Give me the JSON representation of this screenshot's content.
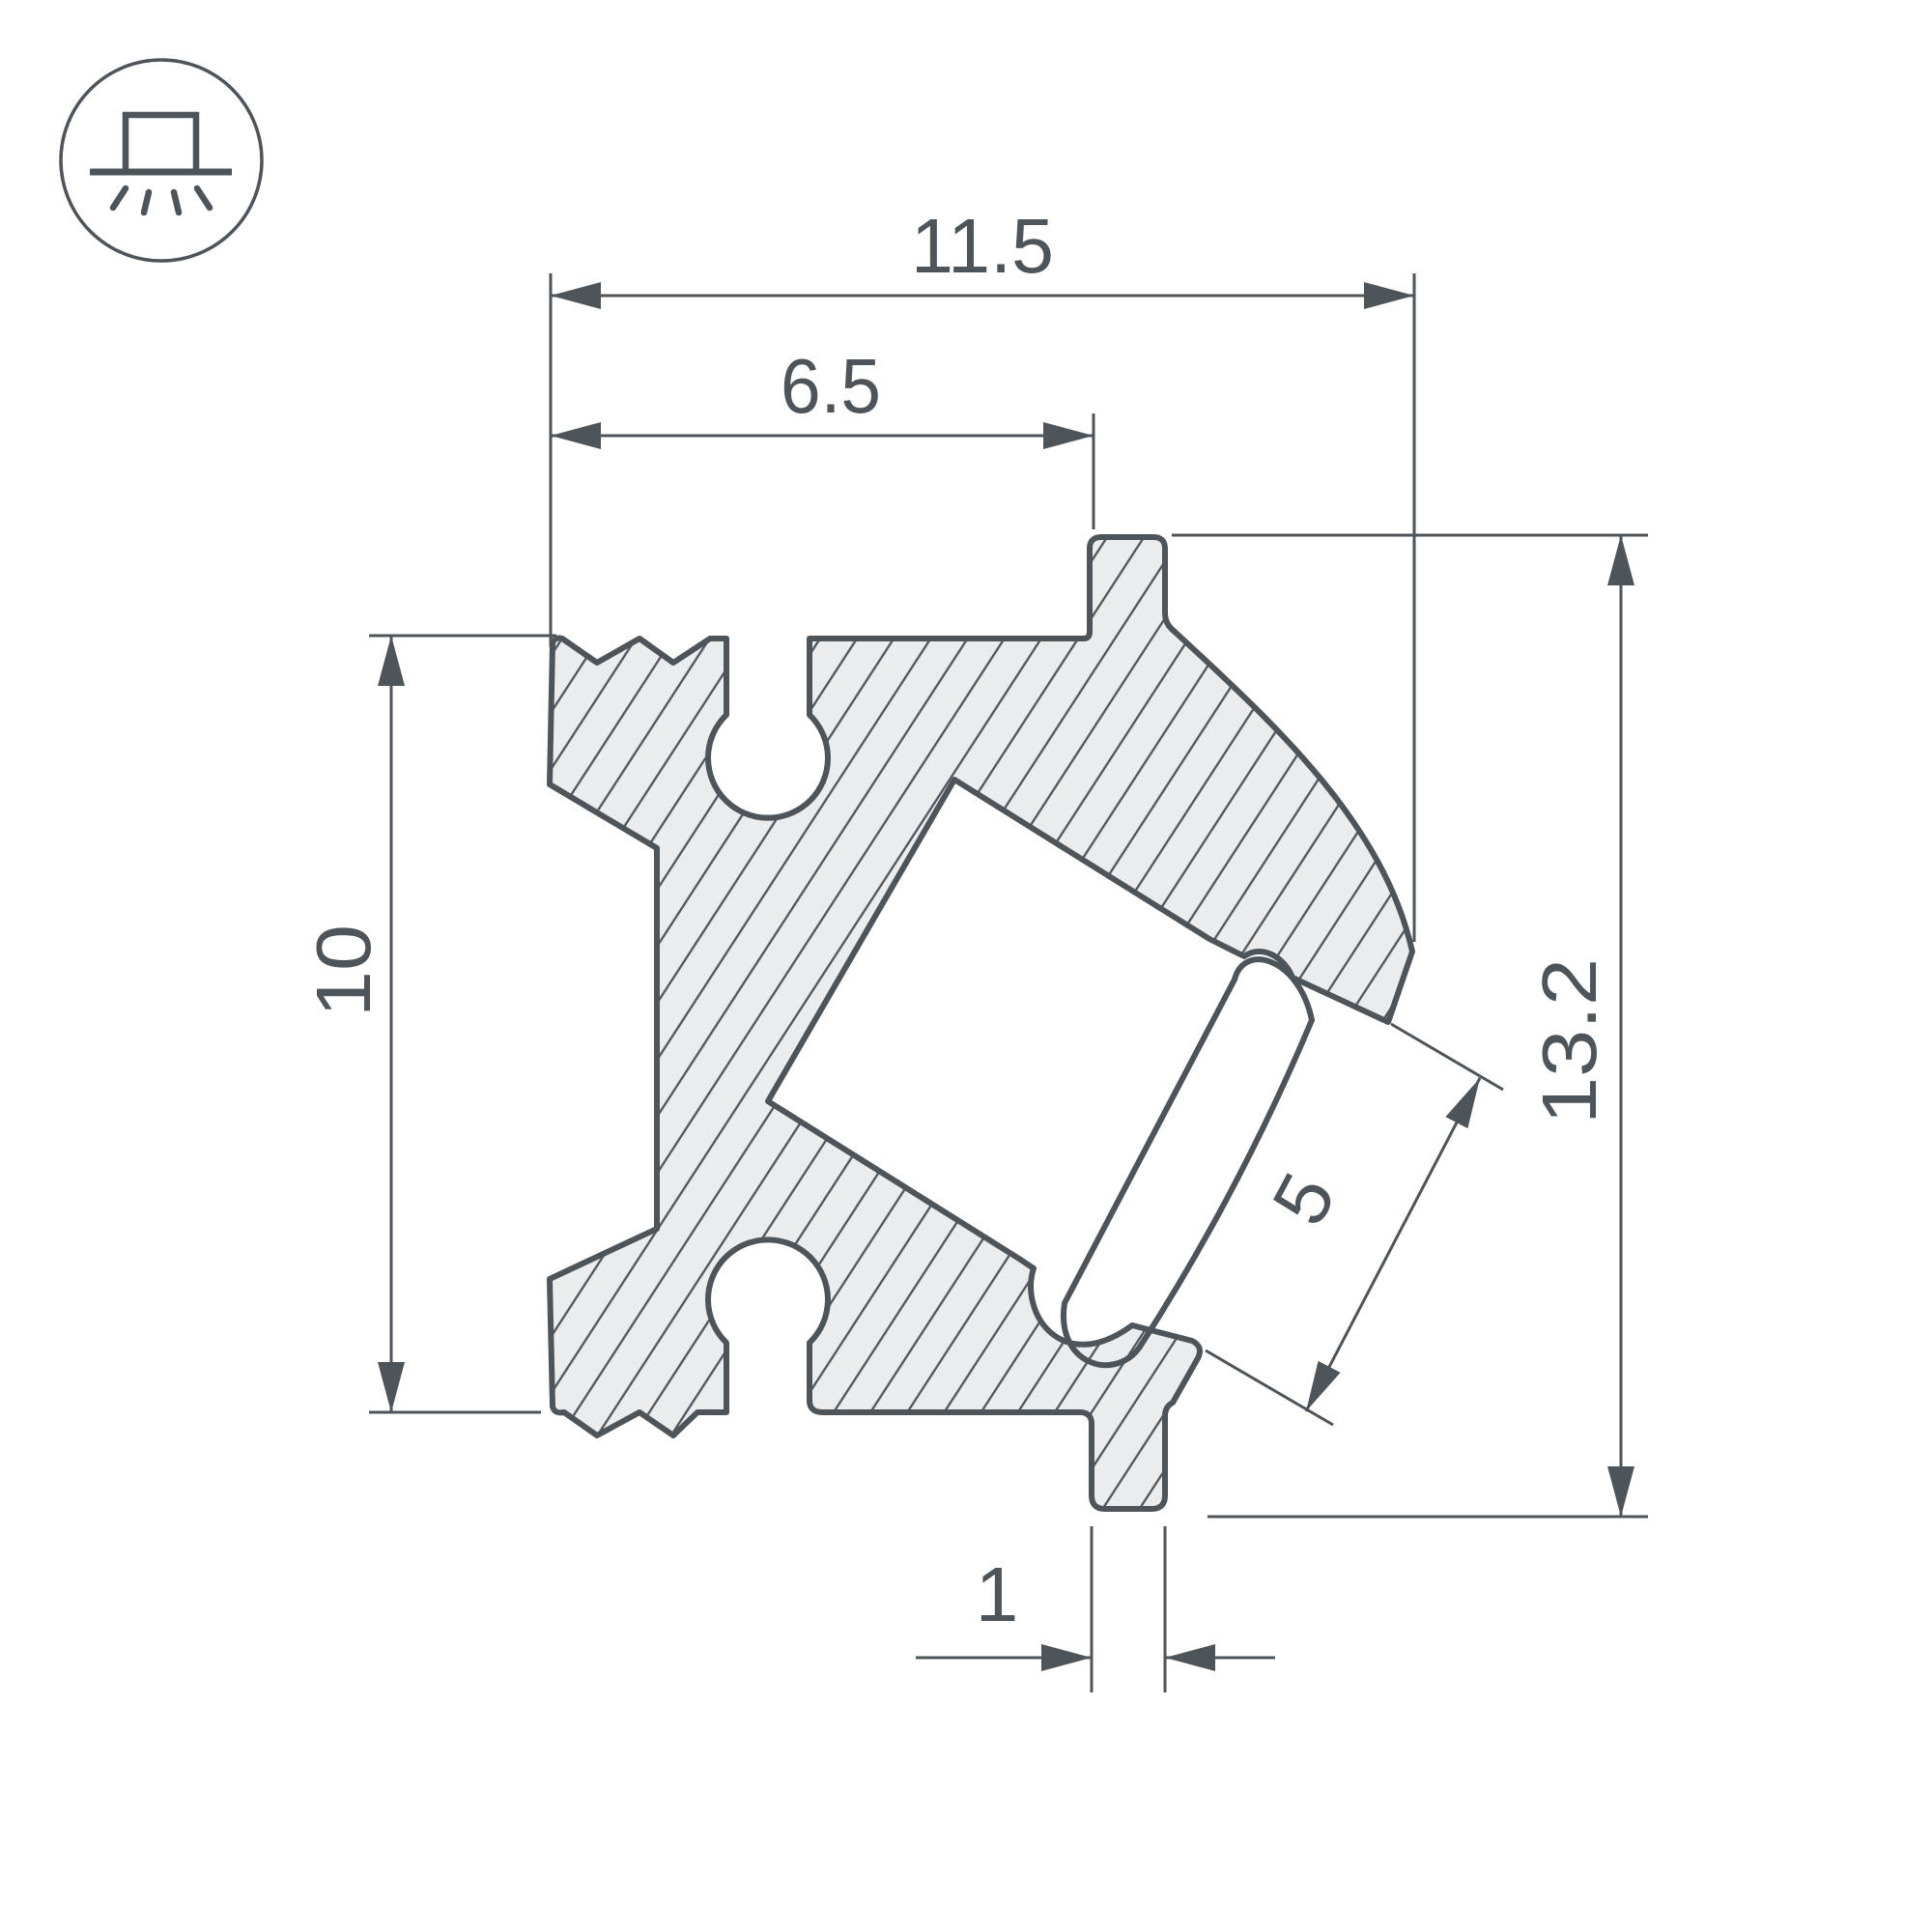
{
  "meta": {
    "type": "technical-drawing",
    "subject": "Corner LED aluminium profile cross-section with dimensions"
  },
  "icon": {
    "name": "surface-mounted-light",
    "description": "surface mounted luminaire shining downward"
  },
  "dimensions": {
    "total_width": "11.5",
    "inner_width": "6.5",
    "left_height": "10",
    "total_height": "13.2",
    "lens_width": "5",
    "foot_width": "1"
  },
  "colors": {
    "line": "#4d545a",
    "profile_fill": "#eaeced",
    "background": "#ffffff"
  }
}
